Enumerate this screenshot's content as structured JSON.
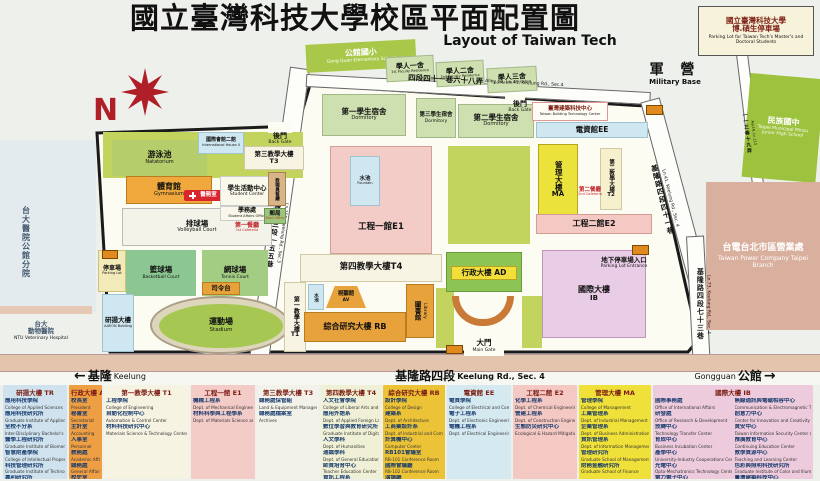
{
  "title": {
    "zh": "國立臺灣科技大學校區平面配置圖",
    "en": "Layout of Taiwan Tech"
  },
  "compass": {
    "label": "N"
  },
  "colors": {
    "accent_red": "#b01e28",
    "campus_fill": "#fdfcf2",
    "lawn": "#c3d45e",
    "orange_building": "#e8a23c",
    "road_band": "#e3c4ad",
    "boundary": "#1a1a1a"
  },
  "parking_box": {
    "line1": "國立臺灣科技大學",
    "line2": "博.碩生停車場",
    "en": "Parking Lot for Taiwan Tech's Master's and Doctoral Students"
  },
  "exterior": {
    "military": {
      "zh": "軍  營",
      "en": "Military Base"
    },
    "minzu": {
      "zh": "民族國中",
      "en": "Taipei Municipal Minzu Junior High School"
    },
    "taipower": {
      "zh": "台電台北市區營業處",
      "en": "Taiwan Power Company Taipei Branch"
    },
    "ntu_hospital": {
      "zh": "台大醫院公館分院"
    },
    "ntu_vet": {
      "zh1": "台大",
      "zh2": "動物醫院",
      "en": "NTU Veterinary Hospital"
    },
    "elementary": {
      "zh": "公館國小",
      "en": "Gong Guan Elementary School"
    }
  },
  "roads": {
    "ln155": {
      "zh": "基隆路三段一五五巷",
      "en": "Ln.155, Keelung Rd., Sec.3"
    },
    "alley68": {
      "zh": "四段四十一巷六十八弄",
      "en": "Alley 68, Ln.41, Keelung Rd., Sec.4"
    },
    "ln41": {
      "zh": "基隆路四段四十一巷",
      "en": "Ln.41, Keelung Rd., Sec. 4"
    },
    "aly19": {
      "zh": "一一三巷十九弄",
      "en": "Aly.19, Ln.113"
    },
    "ln73": {
      "zh": "基隆路四段七十三巷",
      "en": "Ln.73, Keelung Rd., Sec. 4"
    }
  },
  "directions": {
    "keelung": {
      "arrow": "←",
      "zh": "基隆",
      "en": "Keelung"
    },
    "road": {
      "zh": "基隆路四段",
      "en": "Keelung Rd., Sec. 4"
    },
    "gongguan": {
      "en": "Gongguan",
      "zh": "公館",
      "arrow": "→"
    }
  },
  "gates": {
    "main": {
      "zh": "大門",
      "en": "Main Gate"
    },
    "back_left": {
      "zh": "後門",
      "en": "Back Gate"
    },
    "back_top": {
      "zh": "後門",
      "en": "Back Gate"
    }
  },
  "map": {
    "natatorium": {
      "zh": "游泳池",
      "en": "Natatorium"
    },
    "gymnasium": {
      "zh": "體育館",
      "en": "Gymnasium"
    },
    "health": {
      "zh": "醫務室"
    },
    "volleyball": {
      "zh": "排球場",
      "en": "Volleyball Court"
    },
    "basketball": {
      "zh": "籃球場",
      "en": "Basketball Court"
    },
    "tennis": {
      "zh": "網球場",
      "en": "Tennis Court"
    },
    "stadium": {
      "zh": "運動場",
      "en": "Stadium"
    },
    "podium": {
      "zh": "司令台"
    },
    "parking_lot": {
      "zh": "停車場",
      "en": "Parking Lot"
    },
    "aaeon": {
      "zh": "研揚大樓",
      "en": "AAEON Building"
    },
    "intl_house2": {
      "zh": "國際會館二館",
      "en": "International House II"
    },
    "t3": {
      "zh": "第三教學大樓",
      "code": "T3"
    },
    "student_center": {
      "zh": "學生活動中心",
      "en": "Student Center"
    },
    "student_affairs": {
      "zh": "學務處",
      "en": "Student Affairs Office"
    },
    "cafeteria1": {
      "zh": "第一餐廳",
      "en": "1st Cafeteria"
    },
    "staff_cafeteria": {
      "zh": "教職員餐廳",
      "en": "Staff Cafeteria"
    },
    "post_office": {
      "zh": "郵局",
      "en": "Post Office"
    },
    "dorm1": {
      "zh": "第一學生宿舍",
      "en": "Dormitory"
    },
    "dorm2": {
      "zh": "第二學生宿舍",
      "en": "Dormitory"
    },
    "dorm3": {
      "zh": "第三學生宿舍",
      "en": "Dormitory"
    },
    "e1": {
      "zh": "工程一館",
      "code": "E1"
    },
    "fountain_e1": {
      "zh": "水池",
      "en": "Fountain"
    },
    "fountain_t1": {
      "zh": "水池",
      "en": "Fountain"
    },
    "t4": {
      "zh": "第四教學大樓",
      "code": "T4"
    },
    "av": {
      "zh": "視聽館",
      "code": "AV"
    },
    "rb": {
      "zh": "綜合研究大樓",
      "code": "RB"
    },
    "library": {
      "zh": "圖書館",
      "en": "Library"
    },
    "t1": {
      "zh": "第一教學大樓",
      "code": "T1"
    },
    "ad": {
      "zh": "行政大樓",
      "code": "AD"
    },
    "ib": {
      "zh": "國際大樓",
      "code": "IB"
    },
    "parking_entrance": {
      "zh": "地下停車場入口",
      "en": "Parking Lot Entrance"
    },
    "ee": {
      "zh": "電資館",
      "code": "EE"
    },
    "tbtc": {
      "zh": "臺灣建築科技中心",
      "en": "Taiwan Building Technology Center"
    },
    "ma": {
      "zh": "管理大樓",
      "code": "MA"
    },
    "t2": {
      "zh": "第二教學大樓",
      "code": "T2"
    },
    "cafeteria2": {
      "zh": "第二餐廳",
      "en": "2nd Cafeteria"
    },
    "e2": {
      "zh": "工程二館",
      "code": "E2"
    }
  },
  "legend": {
    "columns": [
      {
        "id": "TR",
        "header": "研揚大樓 TR",
        "bg": "#cfe2ee",
        "items": [
          {
            "zh": "應用科技學院",
            "en": "College of Applied Sciences"
          },
          {
            "zh": "應用科技研究所",
            "en": "Graduate Institute of Applied Science and Technology"
          },
          {
            "zh": "全校不分系",
            "en": "Inter-Disciplinary Bachelor's Program"
          },
          {
            "zh": "醫學工程研究所",
            "en": "Graduate Institute of Biomedical Engineering"
          },
          {
            "zh": "智慧財產學院",
            "en": "College of Intellectual Property Studies"
          },
          {
            "zh": "科技管理研究所",
            "en": "Graduate Institute of Technology Management"
          },
          {
            "zh": "專利研究所",
            "en": "Graduate Institute of Patent"
          }
        ]
      },
      {
        "id": "AD",
        "header": "行政大樓 AD",
        "bg": "#ef9f43",
        "items": [
          {
            "zh": "校長室",
            "en": "President"
          },
          {
            "zh": "秘書室",
            "en": "Secretariat"
          },
          {
            "zh": "主計室",
            "en": "Accounting"
          },
          {
            "zh": "人事室",
            "en": "Personnel"
          },
          {
            "zh": "教務處",
            "en": "Academic Affairs"
          },
          {
            "zh": "總務處",
            "en": "General Affairs"
          },
          {
            "zh": "校史室",
            "en": "History Museum"
          }
        ]
      },
      {
        "id": "T1",
        "header": "第一教學大樓 T1",
        "bg": "#f6f3e2",
        "items": [
          {
            "zh": "工程學院",
            "en": "College of Engineering"
          },
          {
            "zh": "自動化控制中心",
            "en": "Automation & Control Center"
          },
          {
            "zh": "材料科技研究中心",
            "en": "Materials Science & Technology Center"
          }
        ]
      },
      {
        "id": "E1",
        "header": "工程一館 E1",
        "bg": "#f3ccc7",
        "items": [
          {
            "zh": "機械工程系",
            "en": "Dept. of Mechanical Engineering"
          },
          {
            "zh": "材料科學與工程學系",
            "en": "Dept. of Materials Science and Engineering"
          }
        ]
      },
      {
        "id": "T3",
        "header": "第三教學大樓 T3",
        "bg": "#f3f2ea",
        "items": [
          {
            "zh": "總務處保管組",
            "en": "Land & Equipment Management"
          },
          {
            "zh": "總務處檔案室",
            "en": "Archives"
          }
        ]
      },
      {
        "id": "T4",
        "header": "第四教學大樓 T4",
        "bg": "#eff0d5",
        "items": [
          {
            "zh": "人文社會學院",
            "en": "College of Liberal Arts and Social Sciences"
          },
          {
            "zh": "應用外語系",
            "en": "Dept. of Applied Foreign Languages"
          },
          {
            "zh": "數位學習與教育研究所",
            "en": "Graduate Institute of Digital Learning and Education"
          },
          {
            "zh": "人文學科",
            "en": "Dept. of Humanities"
          },
          {
            "zh": "通識學科",
            "en": "Dept. of General Education"
          },
          {
            "zh": "師資培育中心",
            "en": "Teacher Education Center"
          },
          {
            "zh": "資訊工程系",
            "en": "Dept. of Computer Science and Information Engineering"
          }
        ]
      },
      {
        "id": "RB",
        "header": "綜合研究大樓 RB",
        "bg": "#ecc337",
        "items": [
          {
            "zh": "設計學院",
            "en": "College of Design"
          },
          {
            "zh": "建築系",
            "en": "Dept. of Architecture"
          },
          {
            "zh": "工商業設計系",
            "en": "Dept. of Industrial and Commercial Design"
          },
          {
            "zh": "計算機中心",
            "en": "Computer Center"
          },
          {
            "zh": "RB101會議室",
            "en": "RB-101 Conference Room"
          },
          {
            "zh": "國際會議廳",
            "en": "RB-102 Conference Room"
          },
          {
            "zh": "演講廳",
            "en": "RB-105 Conference Room"
          }
        ]
      },
      {
        "id": "EE",
        "header": "電資館 EE",
        "bg": "#d5e9f1",
        "items": [
          {
            "zh": "電資學院",
            "en": "College of Electrical and Computer Engineering"
          },
          {
            "zh": "電子工程系",
            "en": "Dept. of Electronic Engineering"
          },
          {
            "zh": "電機工程系",
            "en": "Dept. of Electrical Engineering"
          }
        ]
      },
      {
        "id": "E2",
        "header": "工程二館 E2",
        "bg": "#f4c8c3",
        "items": [
          {
            "zh": "化學工程系",
            "en": "Dept. of Chemical Engineering"
          },
          {
            "zh": "營建工程系",
            "en": "Dept. of Construction Engineering"
          },
          {
            "zh": "生態防災研究中心",
            "en": "Ecological & Hazard Mitigation Engineering Research Center"
          }
        ]
      },
      {
        "id": "MA",
        "header": "管理大樓 MA",
        "bg": "#efe139",
        "items": [
          {
            "zh": "管理學院",
            "en": "College of Management"
          },
          {
            "zh": "工業管理系",
            "en": "Dept. of Industrial Management"
          },
          {
            "zh": "企業管理系",
            "en": "Dept. of Business Administration"
          },
          {
            "zh": "資訊管理系",
            "en": "Dept. of Information Management"
          },
          {
            "zh": "管理研究所",
            "en": "Graduate School of Management"
          },
          {
            "zh": "財務金融研究所",
            "en": "Graduate School of Finance"
          }
        ]
      },
      {
        "id": "IB",
        "header": "國際大樓 IB",
        "bg": "#edcbdc",
        "items": [
          {
            "zh": "國際事務處",
            "en": "Office of International Affairs"
          },
          {
            "zh": "研發處",
            "en": "Office of Research & Development"
          },
          {
            "zh": "技轉中心",
            "en": "Technology Transfer Center"
          },
          {
            "zh": "育成中心",
            "en": "Business Incubation Center"
          },
          {
            "zh": "產學中心",
            "en": "University-Industry Cooperations Center"
          },
          {
            "zh": "光電中心",
            "en": "Opto-Mechatronics Technology Center"
          },
          {
            "zh": "電力電子中心",
            "en": "Power Electronics Technology Center"
          }
        ],
        "items2": [
          {
            "zh": "無線通訊與電磁相容中心",
            "en": "Communication & Electromagnetic Technology Center"
          },
          {
            "zh": "創意力中心",
            "en": "Center for Innovation and Creativity"
          },
          {
            "zh": "資安中心",
            "en": "Taiwan Information Security Center at NTUST"
          },
          {
            "zh": "推廣教育中心",
            "en": "Continuing Education Center"
          },
          {
            "zh": "教學資源中心",
            "en": "Teaching and Learning Center"
          },
          {
            "zh": "色彩與照明科技研究所",
            "en": "Graduate Institute of Color and Illumination Technology"
          },
          {
            "zh": "臺灣建築科技中心",
            "en": "Taiwan Building Technology Center"
          }
        ]
      }
    ]
  }
}
